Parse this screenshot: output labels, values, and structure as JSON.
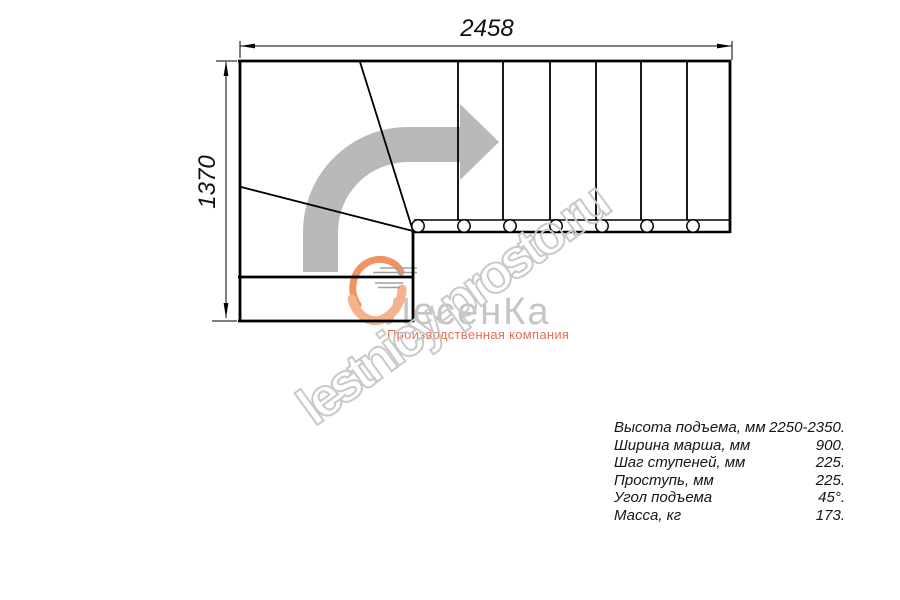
{
  "dimension_labels": {
    "width": "2458",
    "height": "1370"
  },
  "watermark": {
    "text": "lestnicy-prosto.ru",
    "outline_color": "#c9c9c9"
  },
  "logo": {
    "brand": "ЛесенКа",
    "subtitle": "Производственная компания",
    "brand_color": "#c5c5c5",
    "subtitle_color": "#e4705a"
  },
  "specs": {
    "rows": [
      {
        "label": "Высота подъема, мм",
        "value": "2250-2350."
      },
      {
        "label": "Ширина марша, мм",
        "value": "900."
      },
      {
        "label": "Шаг ступеней, мм",
        "value": "225."
      },
      {
        "label": "Проступь, мм",
        "value": "225."
      },
      {
        "label": "Угол подъема",
        "value": "45°."
      },
      {
        "label": "Масса, кг",
        "value": "173."
      }
    ]
  },
  "drawing": {
    "ink": "#000000",
    "arrow_fill": "#b9b9b9",
    "arrow_path": "M303,272 L303,232 A105,105 0 0 1 408,127 L460,127 L460,104 L499,142 L460,180 L460,162 L408,162 A70,70 0 0 0 338,232 L338,272 Z",
    "lines": [
      {
        "name": "top-edge",
        "x1": 238,
        "y1": 61,
        "x2": 731,
        "y2": 61,
        "w": 2.8
      },
      {
        "name": "left-edge",
        "x1": 240,
        "y1": 60,
        "x2": 240,
        "y2": 322,
        "w": 2.8
      },
      {
        "name": "right-edge",
        "x1": 730,
        "y1": 60,
        "x2": 730,
        "y2": 233,
        "w": 2.8
      },
      {
        "name": "landing-bottom-edge",
        "x1": 238,
        "y1": 321,
        "x2": 414,
        "y2": 321,
        "w": 2.8
      },
      {
        "name": "landing-divider",
        "x1": 238,
        "y1": 277,
        "x2": 414,
        "y2": 277,
        "w": 2.8
      },
      {
        "name": "winder-vertical-edge",
        "x1": 413,
        "y1": 231,
        "x2": 413,
        "y2": 322,
        "w": 2.8
      },
      {
        "name": "stringer-top",
        "x1": 414,
        "y1": 220,
        "x2": 730,
        "y2": 220,
        "w": 1.6
      },
      {
        "name": "stringer-bottom",
        "x1": 412,
        "y1": 232,
        "x2": 730,
        "y2": 232,
        "w": 2.4
      },
      {
        "name": "winder-diagonal-upper",
        "x1": 360,
        "y1": 62,
        "x2": 413,
        "y2": 231,
        "w": 1.8
      },
      {
        "name": "winder-diagonal-lower",
        "x1": 241,
        "y1": 187,
        "x2": 413,
        "y2": 231,
        "w": 1.8
      },
      {
        "name": "tread-line-1",
        "x1": 458,
        "y1": 62,
        "x2": 458,
        "y2": 220,
        "w": 1.8
      },
      {
        "name": "tread-line-2",
        "x1": 503,
        "y1": 62,
        "x2": 503,
        "y2": 220,
        "w": 1.8
      },
      {
        "name": "tread-line-3",
        "x1": 550,
        "y1": 62,
        "x2": 550,
        "y2": 220,
        "w": 1.8
      },
      {
        "name": "tread-line-4",
        "x1": 596,
        "y1": 62,
        "x2": 596,
        "y2": 220,
        "w": 1.8
      },
      {
        "name": "tread-line-5",
        "x1": 641,
        "y1": 62,
        "x2": 641,
        "y2": 220,
        "w": 1.8
      },
      {
        "name": "tread-line-6",
        "x1": 687,
        "y1": 62,
        "x2": 687,
        "y2": 220,
        "w": 1.8
      },
      {
        "name": "dim-top-line",
        "x1": 240,
        "y1": 46,
        "x2": 732,
        "y2": 46,
        "w": 1
      },
      {
        "name": "dim-top-ext-left",
        "x1": 240,
        "y1": 41,
        "x2": 240,
        "y2": 58,
        "w": 1
      },
      {
        "name": "dim-top-ext-right",
        "x1": 732,
        "y1": 41,
        "x2": 732,
        "y2": 60,
        "w": 1
      },
      {
        "name": "dim-left-line",
        "x1": 226,
        "y1": 62,
        "x2": 226,
        "y2": 318,
        "w": 1
      },
      {
        "name": "dim-left-ext-top",
        "x1": 216,
        "y1": 61,
        "x2": 237,
        "y2": 61,
        "w": 1
      },
      {
        "name": "dim-left-ext-bottom",
        "x1": 212,
        "y1": 321,
        "x2": 237,
        "y2": 321,
        "w": 1
      }
    ],
    "arrowheads": [
      {
        "name": "dim-arrowhead-left",
        "points": "240,46 255,43.6 255,48.4"
      },
      {
        "name": "dim-arrowhead-right",
        "points": "732,46 717,43.6 717,48.4"
      },
      {
        "name": "dim-arrowhead-up",
        "points": "226,61 223.6,76 228.4,76"
      },
      {
        "name": "dim-arrowhead-down",
        "points": "226,318 223.6,303 228.4,303"
      }
    ],
    "balusters": {
      "cy": 226,
      "r": 6.2,
      "stroke_w": 1.5,
      "cx": [
        418,
        464,
        510,
        556,
        602,
        647,
        693
      ]
    },
    "speedlines": [
      {
        "x1": 380,
        "y1": 268,
        "x2": 417,
        "y2": 268
      },
      {
        "x1": 373,
        "y1": 272.5,
        "x2": 417,
        "y2": 272.5
      },
      {
        "x1": 369,
        "y1": 277,
        "x2": 414,
        "y2": 277
      },
      {
        "x1": 375,
        "y1": 283,
        "x2": 403,
        "y2": 283
      },
      {
        "x1": 378,
        "y1": 287.5,
        "x2": 400,
        "y2": 287.5
      }
    ],
    "swirl_paths": [
      {
        "d": "M 401,272 C 396,260 378,255 365,264 C 352,273 349,292 358,305",
        "w": 7,
        "color": "#ef9364"
      },
      {
        "d": "M 352,299 C 356,315 371,326 385,318 C 396,312 402,300 402,289",
        "w": 9,
        "color": "#f6b28d"
      }
    ]
  }
}
